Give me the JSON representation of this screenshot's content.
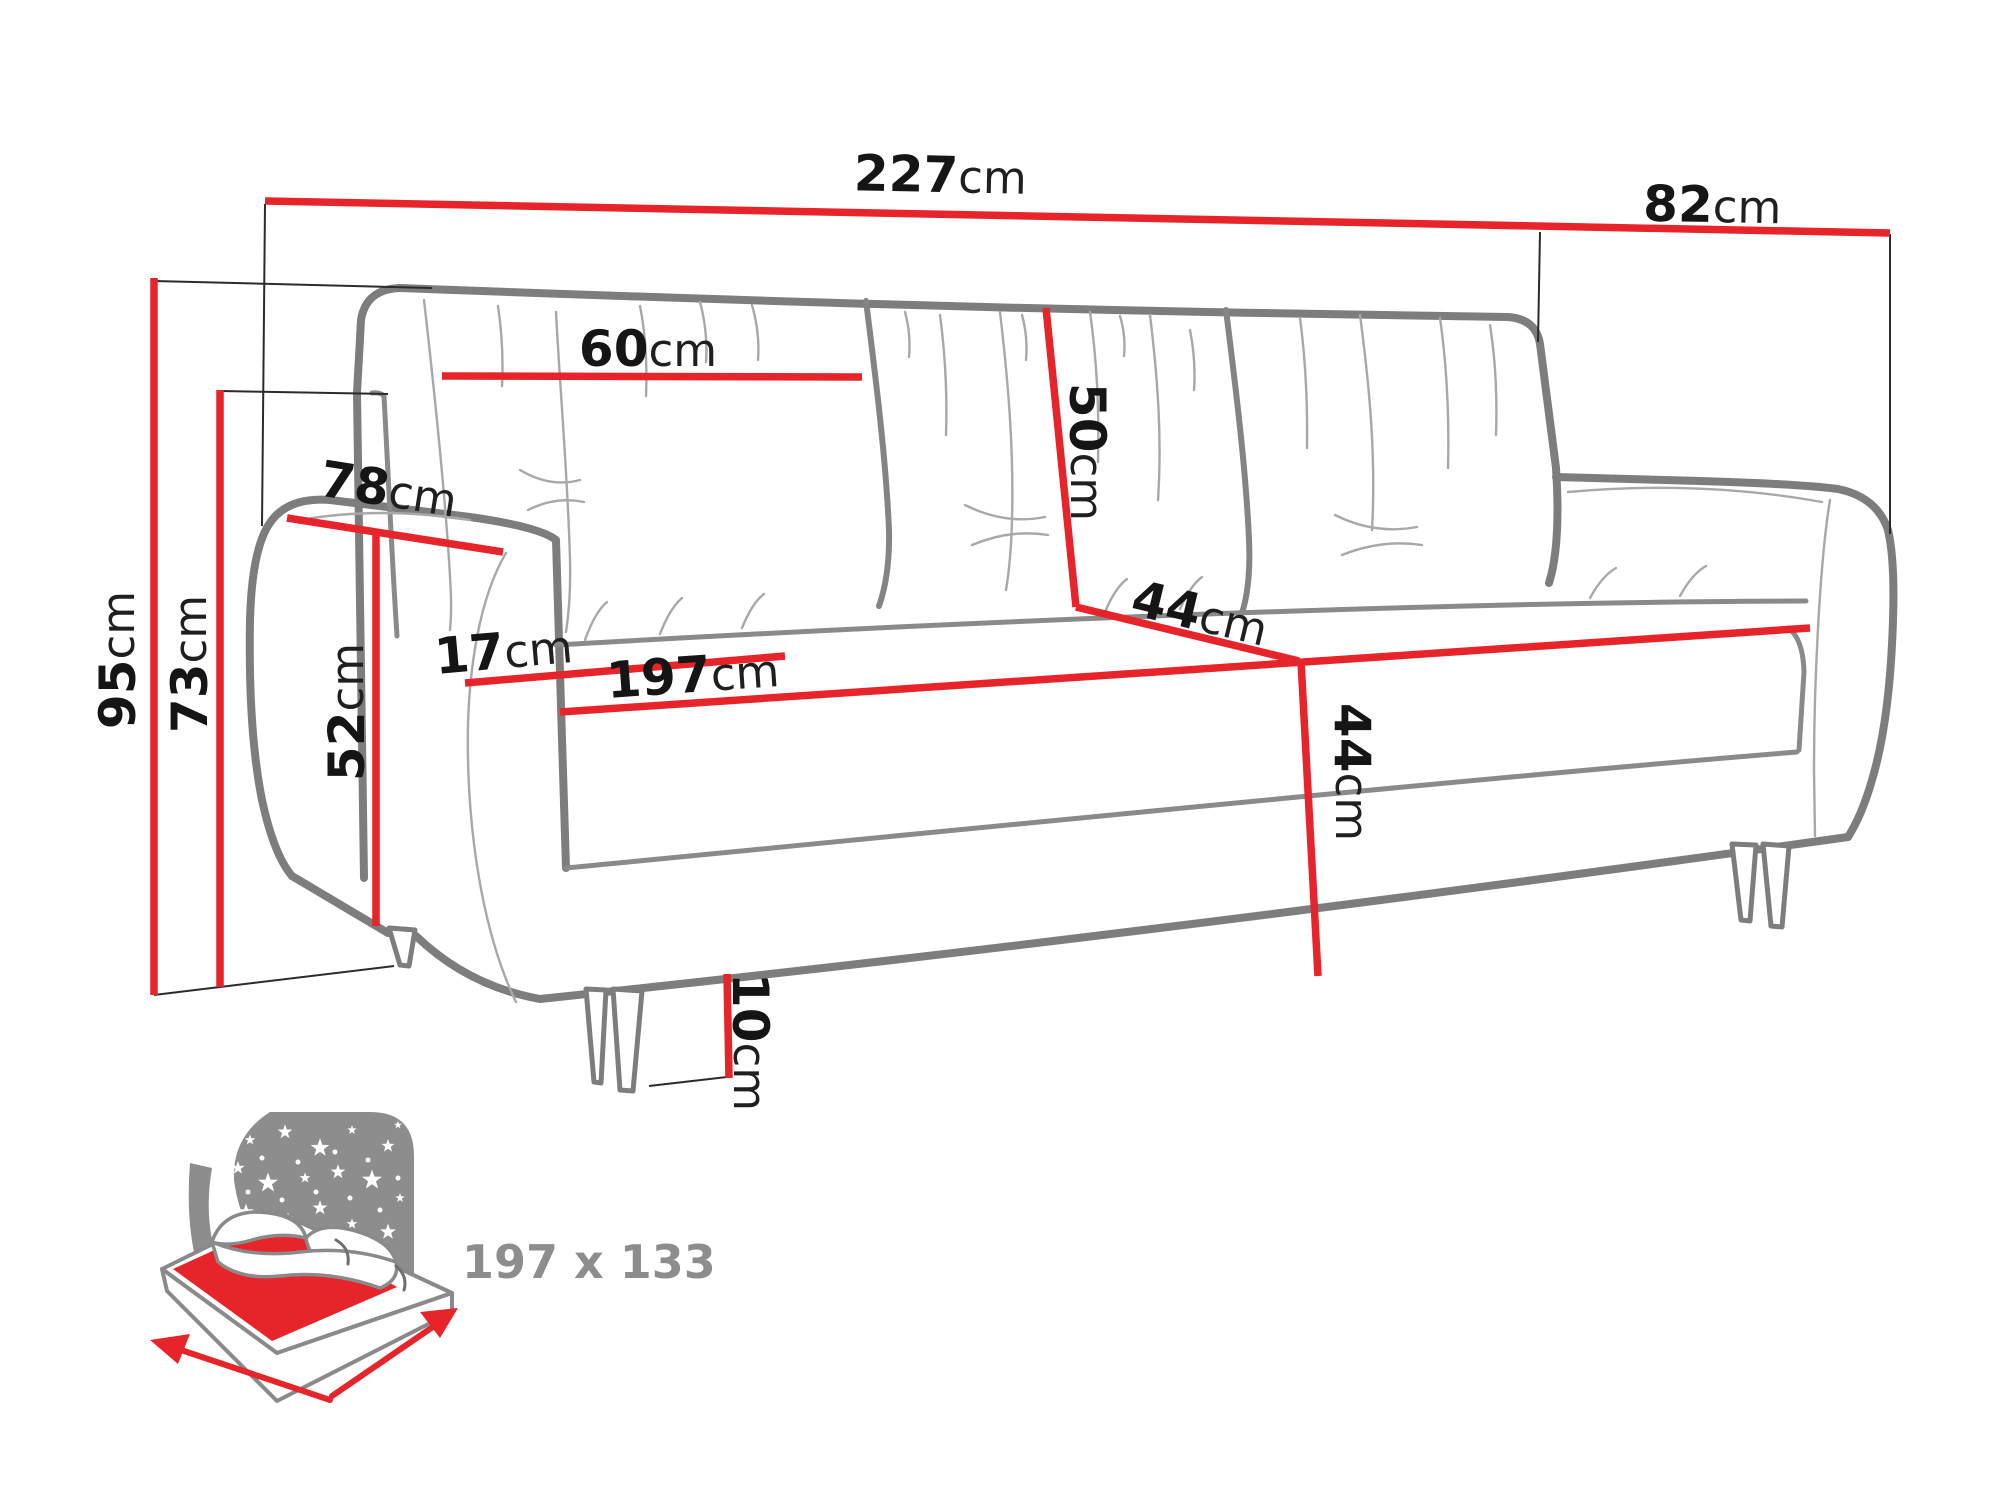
{
  "diagram": {
    "type": "sofa-dimension-drawing",
    "unit": "cm"
  },
  "dims": {
    "overall_width": {
      "value": "227",
      "unit": "cm"
    },
    "overall_depth": {
      "value": "82",
      "unit": "cm"
    },
    "overall_height": {
      "value": "95",
      "unit": "cm"
    },
    "arm_top_height": {
      "value": "73",
      "unit": "cm"
    },
    "back_cushion_width": {
      "value": "60",
      "unit": "cm"
    },
    "back_cushion_height": {
      "value": "50",
      "unit": "cm"
    },
    "arm_depth": {
      "value": "78",
      "unit": "cm"
    },
    "arm_width": {
      "value": "17",
      "unit": "cm"
    },
    "arm_inner_height": {
      "value": "52",
      "unit": "cm"
    },
    "seat_width": {
      "value": "197",
      "unit": "cm"
    },
    "seat_depth": {
      "value": "44",
      "unit": "cm"
    },
    "seat_height": {
      "value": "44",
      "unit": "cm"
    },
    "leg_height": {
      "value": "10",
      "unit": "cm"
    }
  },
  "sleeping_area": {
    "label": "197 x 133"
  },
  "colors": {
    "dimension_red": "#e6242a",
    "outline_gray": "#7d7d7d",
    "label_black": "#151515",
    "icon_gray": "#8d8d8d"
  }
}
